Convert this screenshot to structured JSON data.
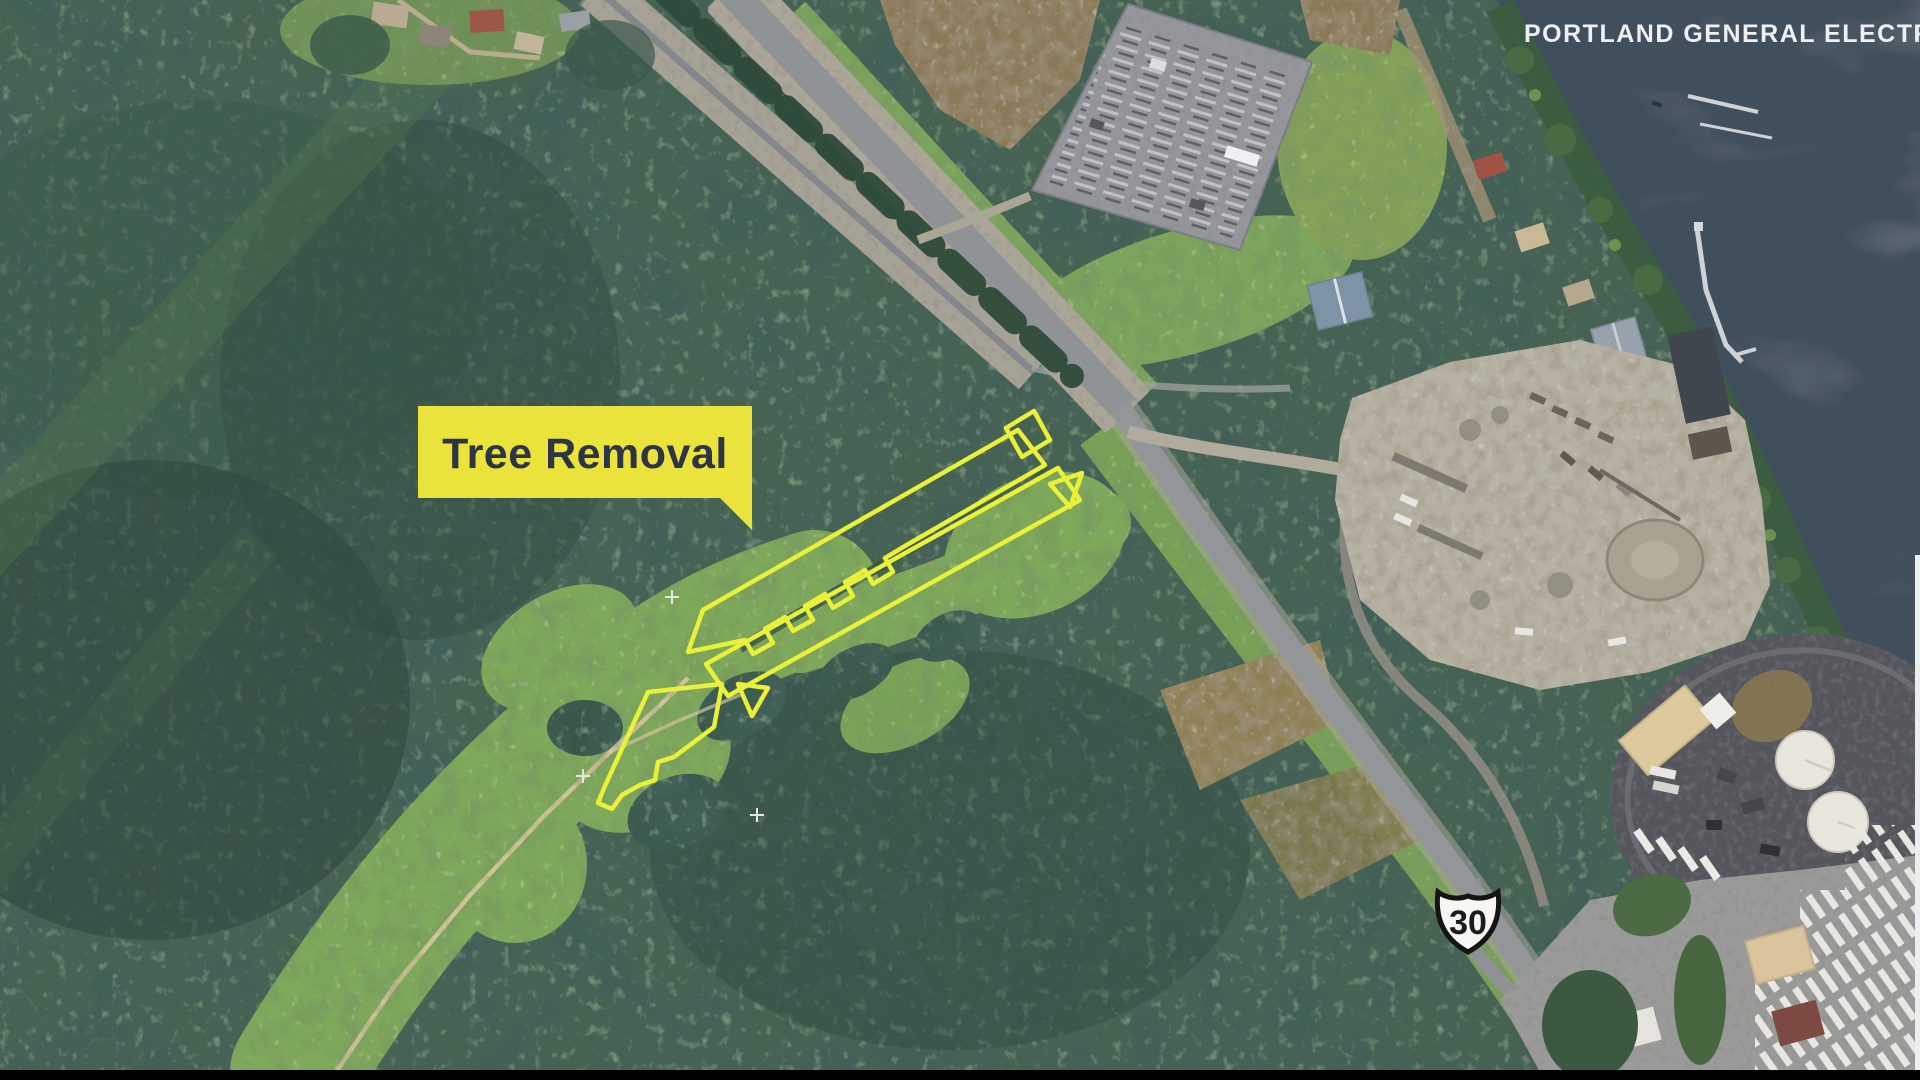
{
  "credit": {
    "text": "PORTLAND GENERAL ELECTRIC",
    "color": "#eef1f4"
  },
  "callout": {
    "label": "Tree Removal",
    "bg_color": "#e9e33c",
    "text_color": "#2d3447",
    "pointer": "bottom-right"
  },
  "highway_shield": {
    "route_number": "30",
    "fill": "#f7f6f2",
    "text_color": "#1c1c1c"
  },
  "annotations": {
    "outline_color": "#e9f239",
    "outlined_region_count": 6
  },
  "scene": {
    "kind": "satellite-aerial",
    "colors": {
      "forest": "#466251",
      "grass": "#7ea85a",
      "water": "#41505c",
      "road": "#8f9396",
      "gravel": "#b7b3a4",
      "dirt_field": "#8a7a58",
      "letterbox": "#000000"
    }
  }
}
